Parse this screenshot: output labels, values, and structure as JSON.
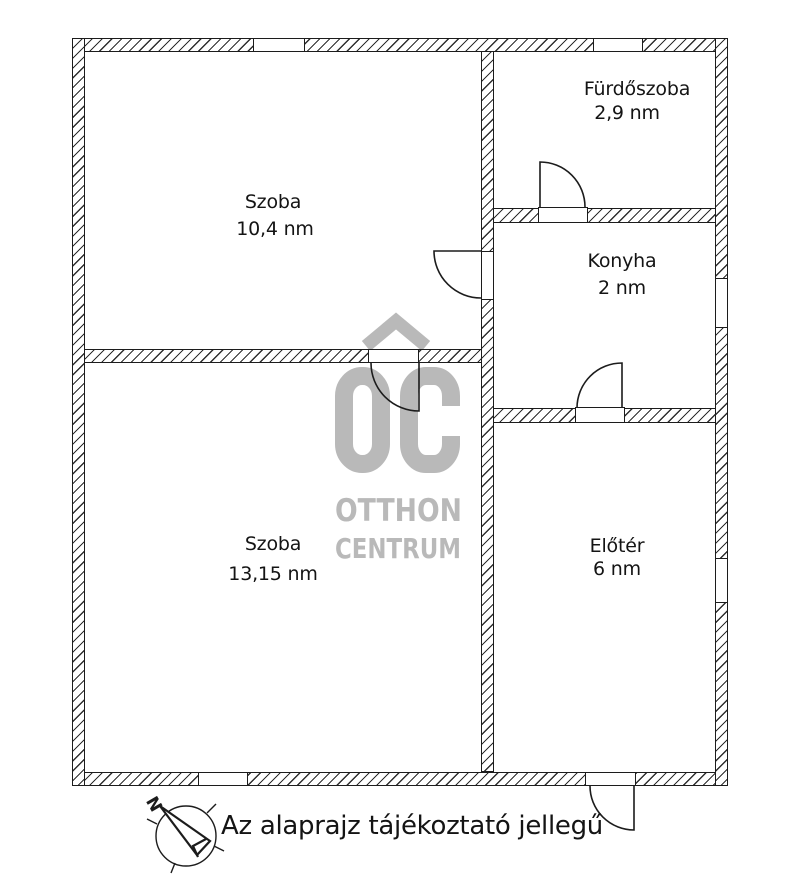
{
  "floor_plan": {
    "rooms": [
      {
        "name": "Szoba",
        "area": "10,4 nm"
      },
      {
        "name": "Fürdőszoba",
        "area": "2,9 nm"
      },
      {
        "name": "Konyha",
        "area": "2 nm"
      },
      {
        "name": "Szoba",
        "area": "13,15 nm"
      },
      {
        "name": "Előtér",
        "area": "6 nm"
      }
    ],
    "watermark": {
      "logo_text": "OC",
      "name_line1": "OTTHON",
      "name_line2": "CENTRUM"
    },
    "compass_label": "N",
    "disclaimer": "Az alaprajz tájékoztató jellegű",
    "colors": {
      "line": "#1c1c1c",
      "watermark_gray": "#b9b9b9",
      "background": "#ffffff"
    }
  }
}
